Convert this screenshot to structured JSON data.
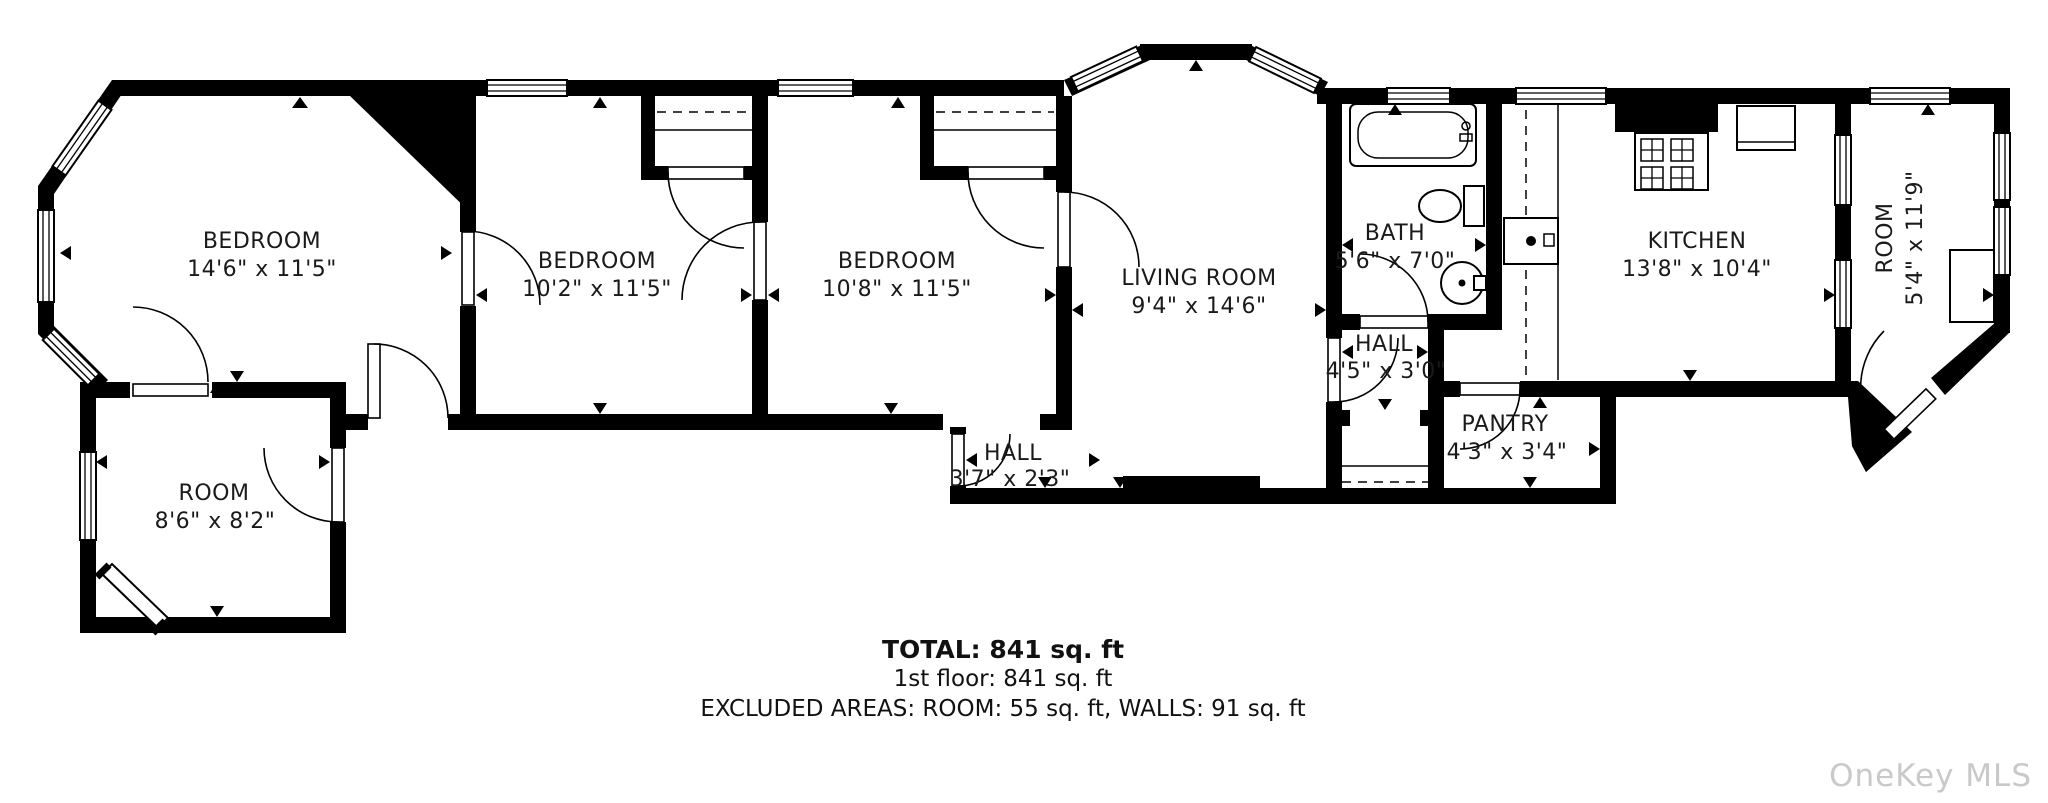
{
  "rooms": [
    {
      "name": "BEDROOM",
      "dims": "14'6\" x 11'5\""
    },
    {
      "name": "BEDROOM",
      "dims": "10'2\" x 11'5\""
    },
    {
      "name": "BEDROOM",
      "dims": "10'8\" x 11'5\""
    },
    {
      "name": "LIVING ROOM",
      "dims": "9'4\" x 14'6\""
    },
    {
      "name": "BATH",
      "dims": "5'6\" x 7'0\""
    },
    {
      "name": "KITCHEN",
      "dims": "13'8\" x 10'4\""
    },
    {
      "name": "ROOM",
      "dims": "5'4\" x 11'9\""
    },
    {
      "name": "HALL",
      "dims": "4'5\" x 3'0\""
    },
    {
      "name": "PANTRY",
      "dims": "4'3\" x 3'4\""
    },
    {
      "name": "HALL",
      "dims": "3'7\" x 2'3\""
    },
    {
      "name": "ROOM",
      "dims": "8'6\" x 8'2\""
    }
  ],
  "summary": {
    "total": "TOTAL: 841 sq. ft",
    "floor": "1st floor: 841 sq. ft",
    "excluded": "EXCLUDED AREAS: ROOM: 55 sq. ft, WALLS: 91 sq. ft"
  },
  "watermark": "OneKey MLS",
  "colors": {
    "wall": "#000000",
    "text": "#1a1a1a",
    "watermark": "#c9c9c9"
  }
}
